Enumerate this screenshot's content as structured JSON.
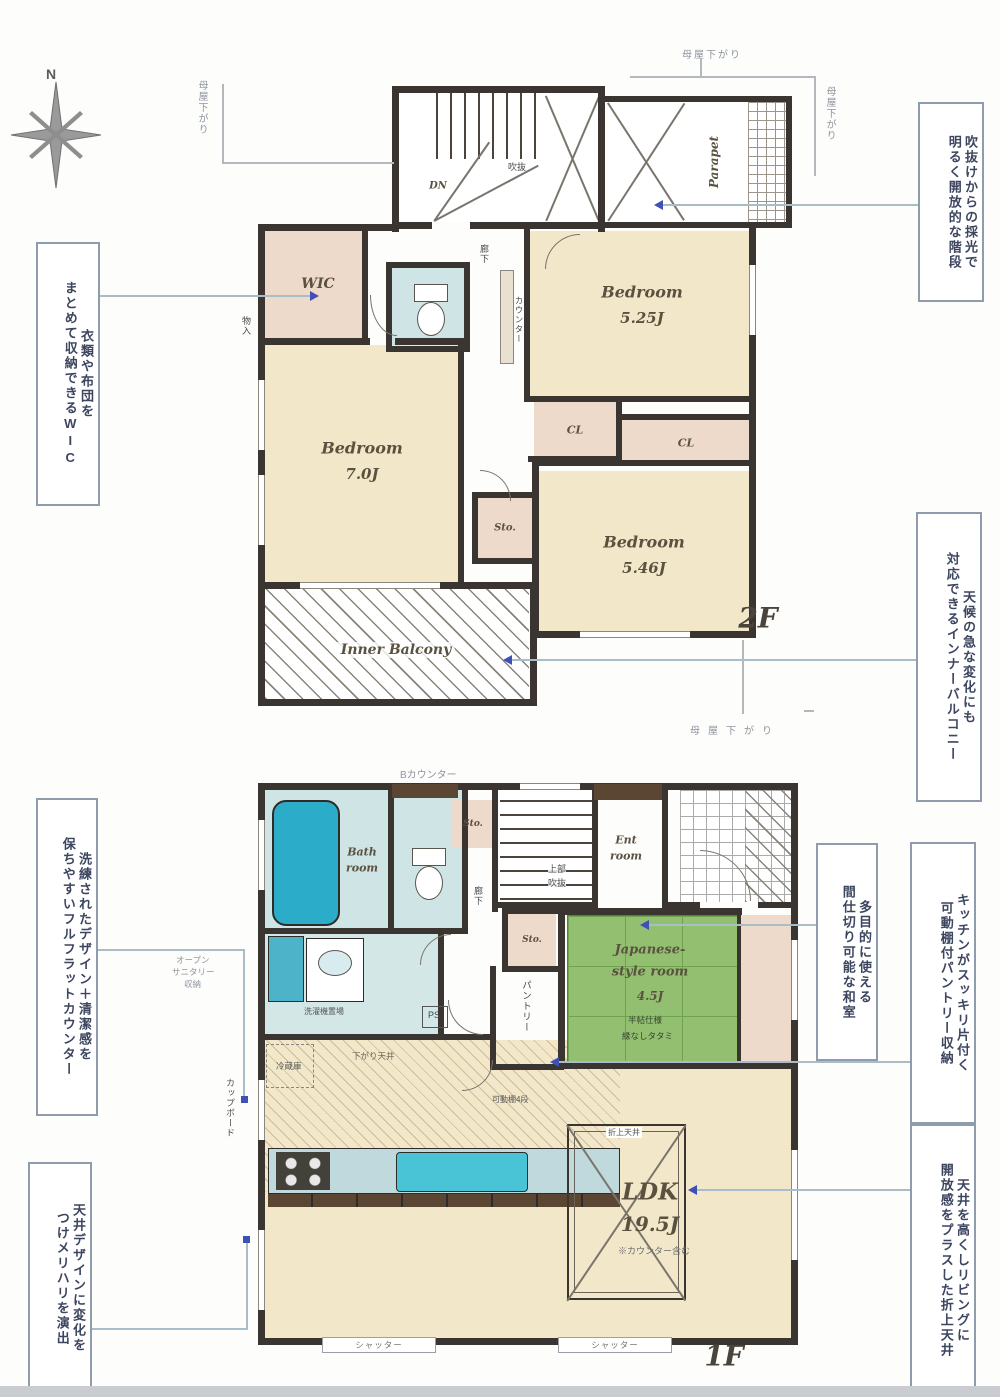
{
  "compass": {
    "n": "N"
  },
  "f2": {
    "label": "2F",
    "wic": "WIC",
    "dn": "DN",
    "fukinuke": "吹抜",
    "parapet": "Parapet",
    "bed1": {
      "n": "Bedroom",
      "s": "5.25J"
    },
    "bed2": {
      "n": "Bedroom",
      "s": "7.0J"
    },
    "bed3": {
      "n": "Bedroom",
      "s": "5.46J"
    },
    "cl": "CL",
    "sto": "Sto.",
    "monoire": "物入",
    "rouka": "廊下",
    "counter": "カウンター",
    "balcony": "Inner Balcony",
    "moyasagari": "母屋下がり"
  },
  "f1": {
    "label": "1F",
    "bath": {
      "l1": "Bath",
      "l2": "room"
    },
    "ent": {
      "l1": "Ent",
      "l2": "room"
    },
    "jp": {
      "l1": "Japanese-",
      "l2": "style room",
      "size": "4.5J",
      "n1": "半帖仕様",
      "n2": "縁なしタタミ"
    },
    "ldk": {
      "l1": "LDK",
      "size": "19.5J",
      "note": "※カウンター含む"
    },
    "pantry": "パントリー",
    "bcounter": "Bカウンター",
    "open_storage": {
      "l1": "オープン",
      "l2": "サニタリー",
      "l3": "収納"
    },
    "laundry": "洗濯機置場",
    "fridge": "冷蔵庫",
    "sagari": "下がり天井",
    "kadou": "可動棚4段",
    "oriage": "折上天井",
    "joubu": {
      "l1": "上部",
      "l2": "吹抜"
    },
    "ps": "PS",
    "sto": "Sto.",
    "cupboard": "カップボード",
    "shutter": "シャッター",
    "rouka": "廊下"
  },
  "ann": {
    "wic": {
      "c1": "衣類や布団を",
      "c2": "まとめて収納できるWIC"
    },
    "stair": {
      "c1": "吹抜けからの採光で",
      "c2": "明るく開放的な階段"
    },
    "balcony": {
      "c1": "天候の急な変化にも",
      "c2": "対応できるインナーバルコニー"
    },
    "washitsu": {
      "c1": "多目的に使える",
      "c2": "間仕切り可能な和室"
    },
    "pantry": {
      "c1": "キッチンがスッキリ片付く",
      "c2": "可動棚付パントリー収納"
    },
    "oriage": {
      "c1": "天井を高くしリビングに",
      "c2": "開放感をプラスした折上天井"
    },
    "counter": {
      "c1": "洗練されたデザイン＋清潔感を",
      "c2": "保ちやすいフルフラットカウンター"
    },
    "ceiling": {
      "c1": "天井デザインに変化を",
      "c2": "つけメリハリを演出"
    }
  },
  "colors": {
    "wall": "#3a3530",
    "floor": "#f2e8c9",
    "closet": "#eedacb",
    "tatami": "#8fbd6e",
    "water": "#cfe4e4",
    "tub": "#2badc9",
    "arrow": "#3f51b5"
  }
}
